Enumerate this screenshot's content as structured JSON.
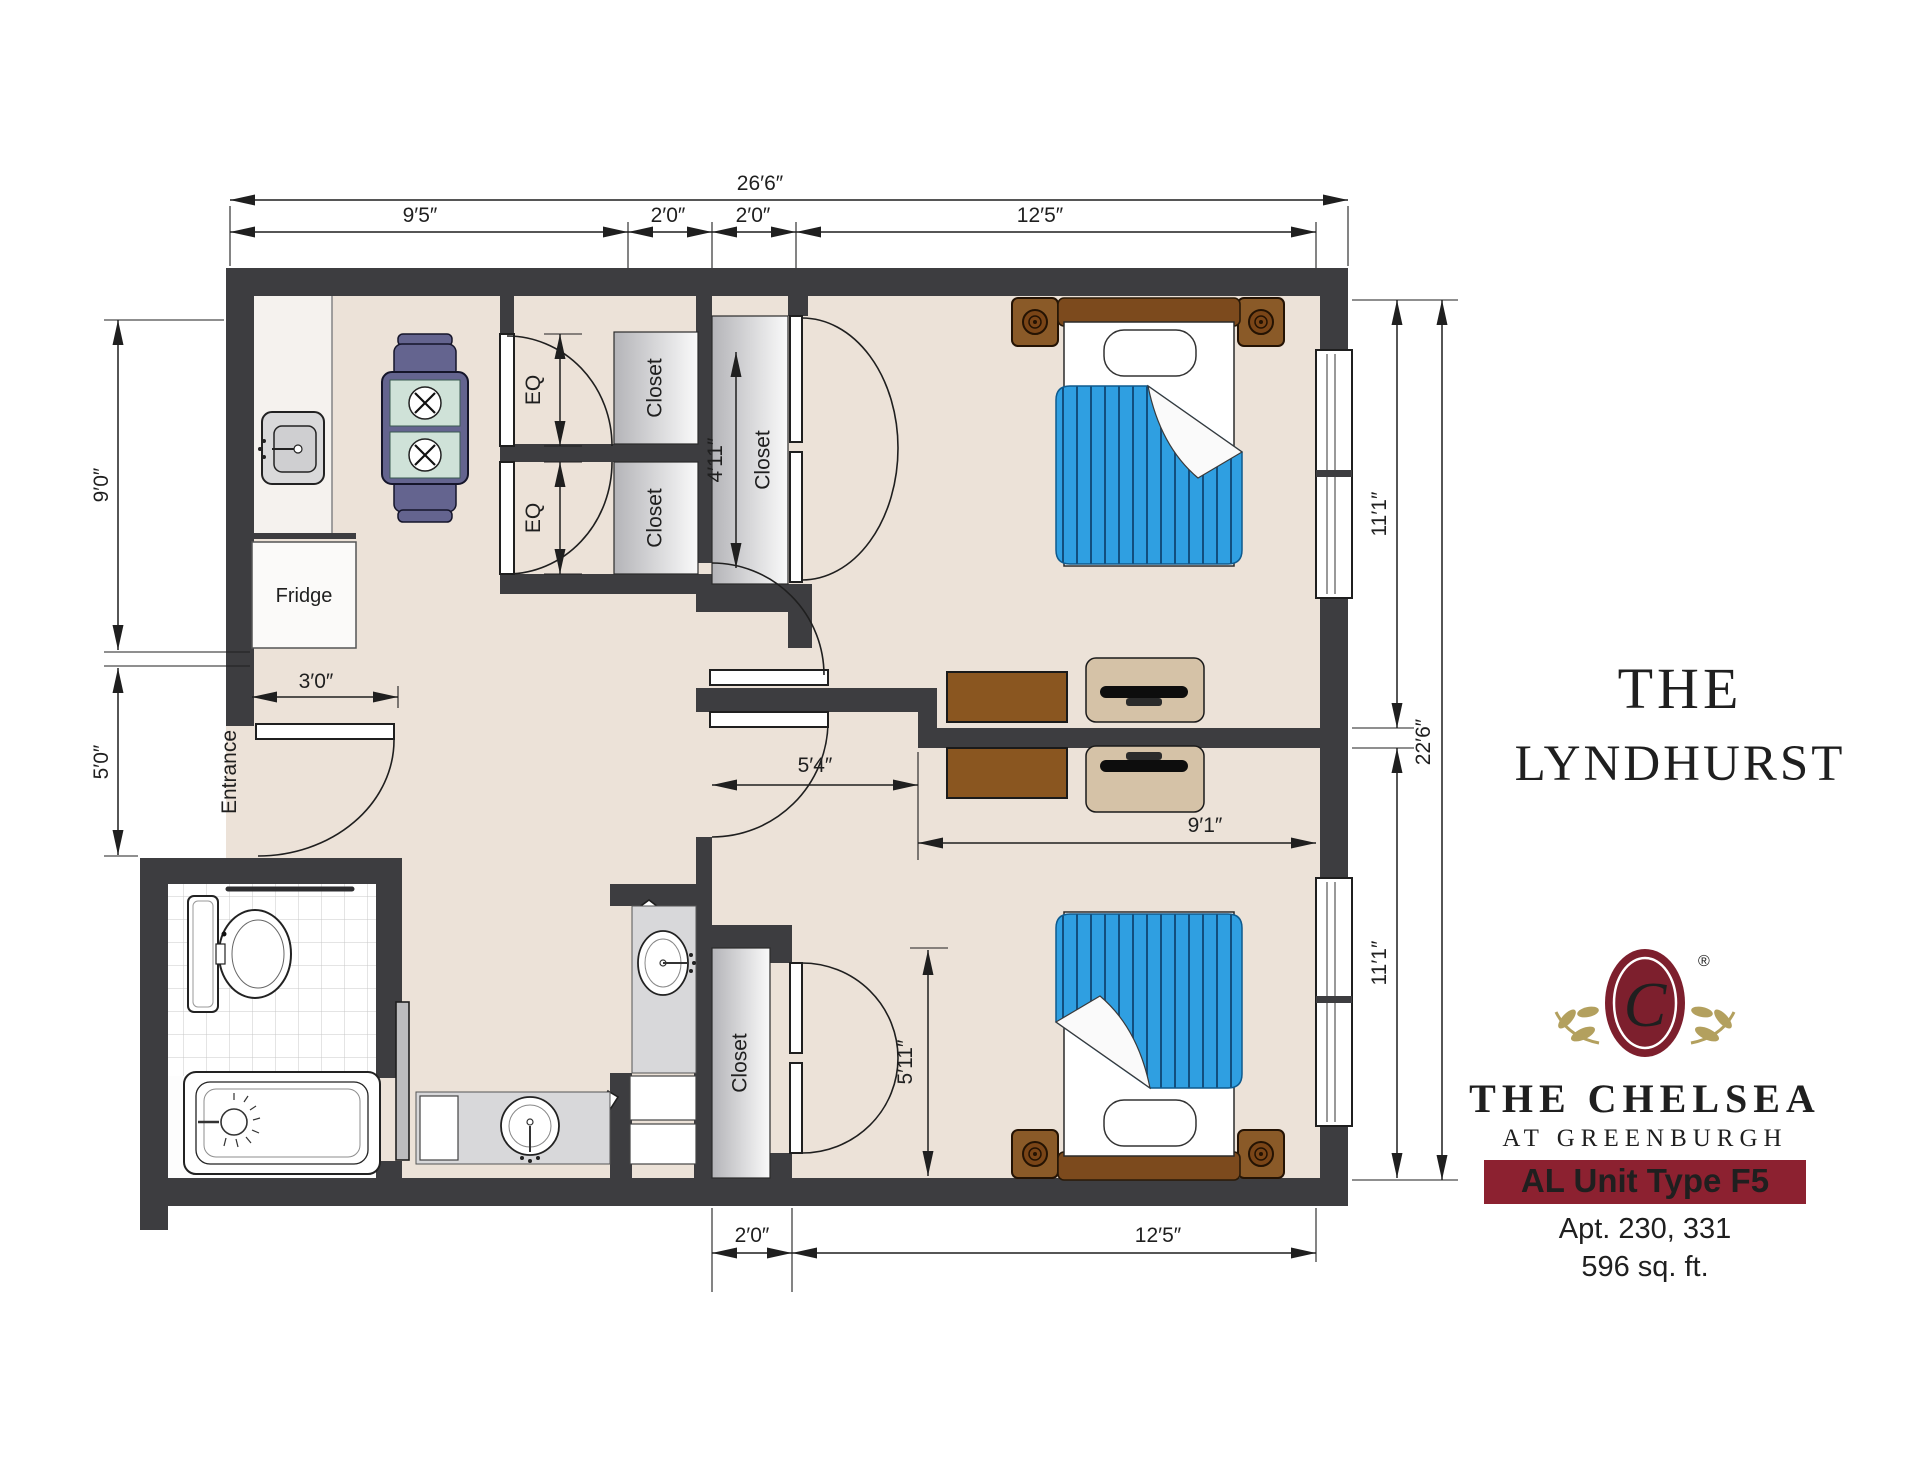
{
  "colors": {
    "wall": "#3d3d40",
    "floor": "#ece2d8",
    "blanket_blue": "#2f9fe1",
    "brand_maroon": "#8c2130",
    "brand_gold": "#a5914d"
  },
  "plan": {
    "dims": {
      "overall_top": "26′6″",
      "top_kitchen": "9′5″",
      "top_closet_a": "2′0″",
      "top_closet_b": "2′0″",
      "top_bedroom1": "12′5″",
      "left_kitchen": "9′0″",
      "left_entry": "5′0″",
      "entry_door": "3′0″",
      "eq_upper": "EQ",
      "eq_lower": "EQ",
      "closet_depth": "4′11″",
      "hall": "5′4″",
      "bedroom2_width": "9′1″",
      "closet2_height": "5′11″",
      "bottom_closet": "2′0″",
      "bottom_bedroom2": "12′5″",
      "right_bedroom1": "11′1″",
      "right_total": "22′6″",
      "right_bedroom2": "11′1″"
    },
    "labels": {
      "closet_upper": "Closet",
      "closet_lower": "Closet",
      "closet_bedroom1": "Closet",
      "closet_bedroom2": "Closet",
      "fridge": "Fridge",
      "entrance": "Entrance"
    }
  },
  "branding": {
    "title_line1": "THE",
    "title_line2": "LYNDHURST",
    "monogram": "C",
    "registered": "®",
    "name": "THE CHELSEA",
    "location": "AT GREENBURGH",
    "unit_type": "AL Unit Type F5",
    "apartments": "Apt. 230, 331",
    "area": "596 sq. ft."
  }
}
